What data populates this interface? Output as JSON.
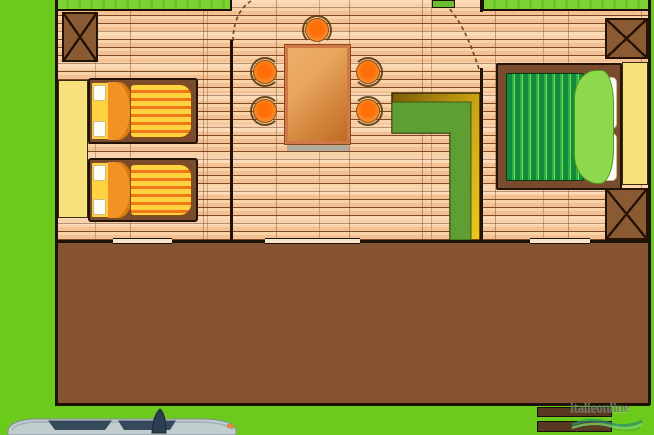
{
  "scene": {
    "type": "floor-plan-illustration",
    "description": "Top-down floor plan of a mobile home with wooden interior floor, front terrace deck, lawn around, car parked at bottom edge",
    "rooms": [
      {
        "name": "twin-bedroom",
        "furniture": [
          "wardrobe",
          "single-bed",
          "single-bed"
        ]
      },
      {
        "name": "living-dining-room",
        "furniture": [
          "dining-table",
          "stools",
          "l-shaped-kitchen-counter"
        ]
      },
      {
        "name": "double-bedroom",
        "furniture": [
          "double-bed",
          "wardrobe"
        ]
      },
      {
        "name": "terrace-deck",
        "furniture": [
          "steps"
        ]
      }
    ],
    "counts": {
      "stools": 5,
      "single_beds": 2,
      "double_beds": 1,
      "posts": 3,
      "steps": 2,
      "wall_openings": 3,
      "door_arcs": 2,
      "wardrobes": 2,
      "cars": 1
    }
  },
  "watermark": {
    "brand": "italieonline",
    "logo": "wave-logo"
  },
  "colors": {
    "lawn": "#6bca1c",
    "lawn-stripe": "#7cd235",
    "wood-base": "#f3c193",
    "wood-light": "#f9d2a8",
    "wood-line": "#7b4a26",
    "wall": "#1d1205",
    "deck": "#855331",
    "post": "#8a5a33",
    "frame": "#7a4c2e",
    "sheet-y": "#ffd23f",
    "duvet-y": "#ffd23f",
    "duvet-o": "#f07818",
    "fold": "#f29224",
    "wardrobe": "#f6e17c",
    "duvet-g1": "#0f8c3c",
    "blanket": "#8ed84e",
    "pillow": "#fdfdf5",
    "table-light": "#e9a45c",
    "table-dark": "#bf6a22",
    "table-edge": "#d07848",
    "stool-core": "#ff6f08",
    "stool-rim": "#f59033",
    "counter-gold": "#e3bb16",
    "counter-olive": "#7a5c08",
    "counter-green": "#5f9e33",
    "step": "#583820",
    "opening": "#f4e6c8",
    "car-body": "#c2cdd0",
    "car-window": "#36495c",
    "shadow": "#b3ab9c",
    "wm-color": "#6e7d69",
    "wave": "#2e8f6a"
  }
}
